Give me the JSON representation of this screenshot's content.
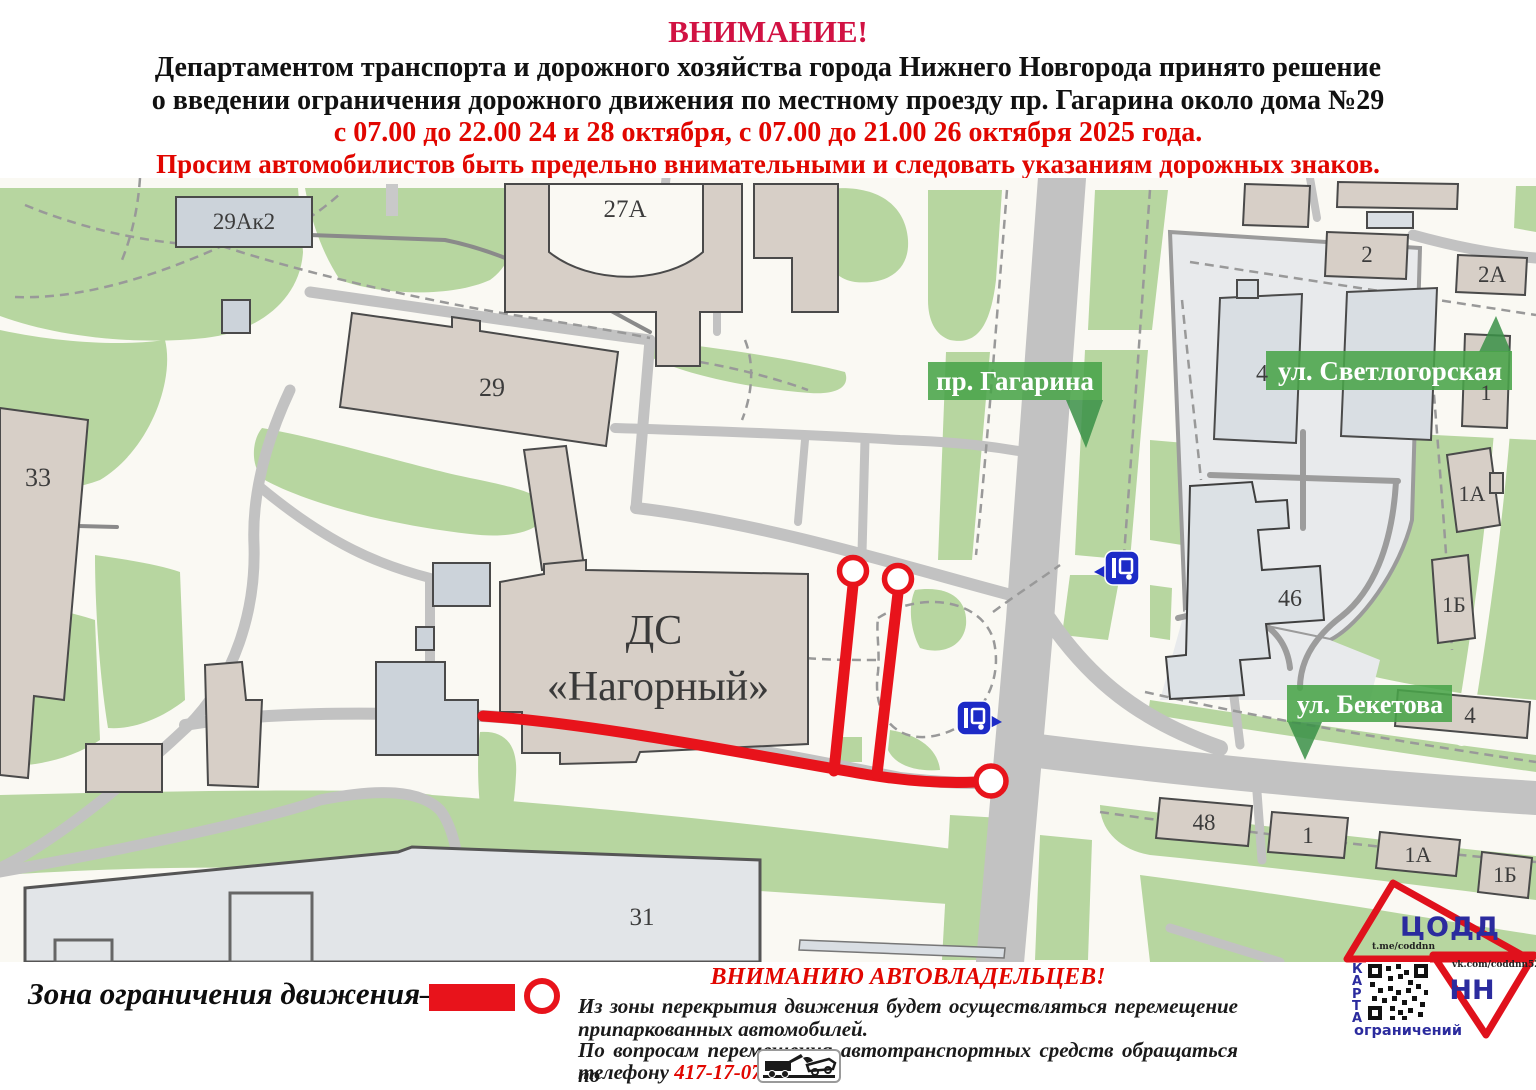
{
  "header": {
    "attention": "ВНИМАНИЕ!",
    "line1": "Департаментом транспорта и дорожного хозяйства города Нижнего Новгорода принято решение",
    "line2": "о введении ограничения дорожного движения по местному проезду пр. Гагарина около дома №29",
    "line3": "с 07.00 до 22.00 24 и 28 октября, с 07.00 до 21.00 26 октября 2025 года.",
    "line4": "Просим автомобилистов быть предельно внимательными и следовать указаниям дорожных знаков."
  },
  "map": {
    "street_labels": {
      "gagarina": "пр. Гагарина",
      "svetlogorskaya": "ул. Светлогорская",
      "beketova": "ул. Бекетова"
    },
    "building_labels": {
      "b29ak2": "29Ак2",
      "b27a": "27А",
      "b29": "29",
      "b33": "33",
      "b31": "31",
      "b46": "46",
      "b2": "2",
      "b2a": "2А",
      "b4_top": "4",
      "b1_top": "1",
      "b1a_right": "1А",
      "b1b_right": "1Б",
      "b4_beketova": "4",
      "b48": "48",
      "b1_bottom": "1",
      "b1a_bottom": "1А",
      "b1b_bottom": "1Б",
      "palace_line1": "ДС",
      "palace_line2": "«Нагорный»"
    }
  },
  "legend": {
    "zone_label": "Зона ограничения движения–",
    "notice_title": "ВНИМАНИЮ АВТОВЛАДЕЛЬЦЕВ!",
    "notice_line1": "Из зоны перекрытия движения будет осуществляться перемещение",
    "notice_line2": "припаркованных автомобилей.",
    "notice_line3": "По вопросам перемещения автотранспортных средств обращаться по",
    "notice_phone_prefix": "телефону",
    "notice_phone": "417-17-07"
  },
  "logo": {
    "org": "ЦОДД",
    "city": "НН",
    "telegram": "t.me/coddnn",
    "vk": "vk.com/coddnn52",
    "qr_caption_vertical": "КАРТА",
    "qr_caption_bottom": "ограничений"
  },
  "colors": {
    "restriction_red": "#e8131b",
    "badge_green": "#49a449",
    "bus_icon_blue": "#1d2bc7",
    "logo_red": "#e0111c",
    "logo_blue": "#2b2b9e",
    "attention_crimson": "#d11243",
    "warning_red": "#e10600",
    "map_green": "#b7d6a0",
    "building_tan": "#d7cfc7",
    "building_bluegray": "#ccd3da",
    "road_gray": "#c2c2c2"
  }
}
